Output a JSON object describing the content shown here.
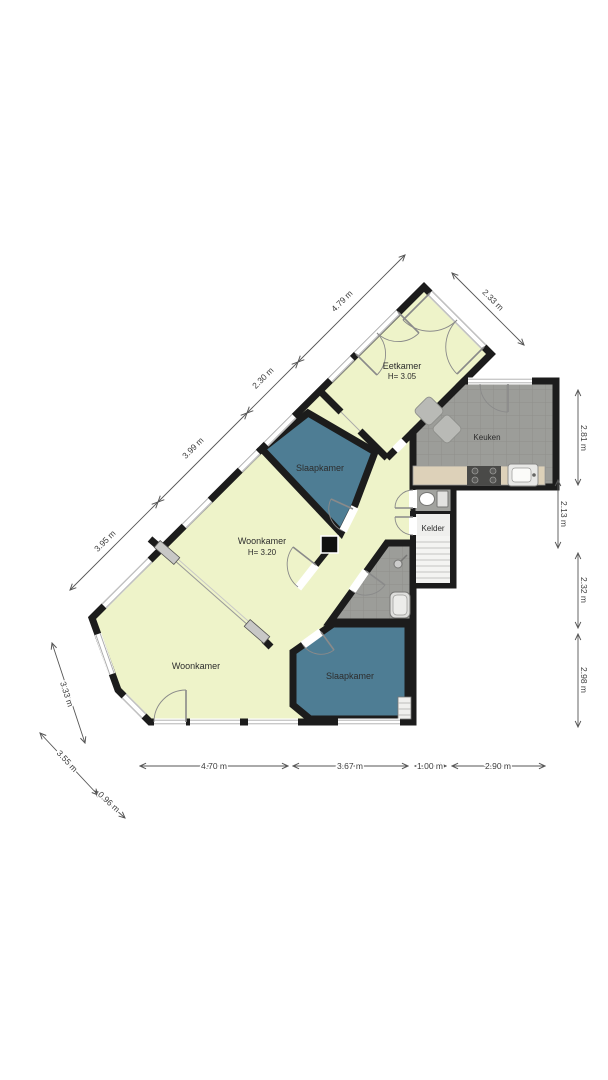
{
  "plan": {
    "rooms": [
      {
        "id": "eetkamer",
        "label": "Eetkamer",
        "height_label": "H= 3.05"
      },
      {
        "id": "keuken",
        "label": "Keuken"
      },
      {
        "id": "kelder",
        "label": "Kelder"
      },
      {
        "id": "slaapkamer-boven",
        "label": "Slaapkamer"
      },
      {
        "id": "woonkamer-midden",
        "label": "Woonkamer",
        "height_label": "H= 3.20"
      },
      {
        "id": "slaapkamer-onder",
        "label": "Slaapkamer"
      },
      {
        "id": "woonkamer",
        "label": "Woonkamer"
      }
    ],
    "dimensions": {
      "top_left": [
        "3.95 m",
        "3.99 m",
        "2.30 m",
        "4.79 m"
      ],
      "top_right": [
        "2.33 m"
      ],
      "right": [
        "2.81 m",
        "2.13 m",
        "2.32 m",
        "2.98 m"
      ],
      "bottom": [
        "4.70 m",
        "3.67 m",
        "1.00 m",
        "2.90 m"
      ],
      "bottom_left": [
        "3.33 m",
        "3.55 m",
        "0.96 m"
      ]
    },
    "colors": {
      "wall": "#1c1c1c",
      "living_area": "#eef3c9",
      "bedroom": "#4e7d94",
      "kitchen_floor": "#9c9d99",
      "cellar": "#efefed",
      "counter": "#ddd1b9",
      "dimension_text": "#3d3d3d"
    },
    "fixtures": [
      "toilet",
      "cellar-stairs",
      "stove",
      "kitchen-sink",
      "shower",
      "bathtub",
      "radiator",
      "seating",
      "sliding-doors",
      "column"
    ]
  }
}
